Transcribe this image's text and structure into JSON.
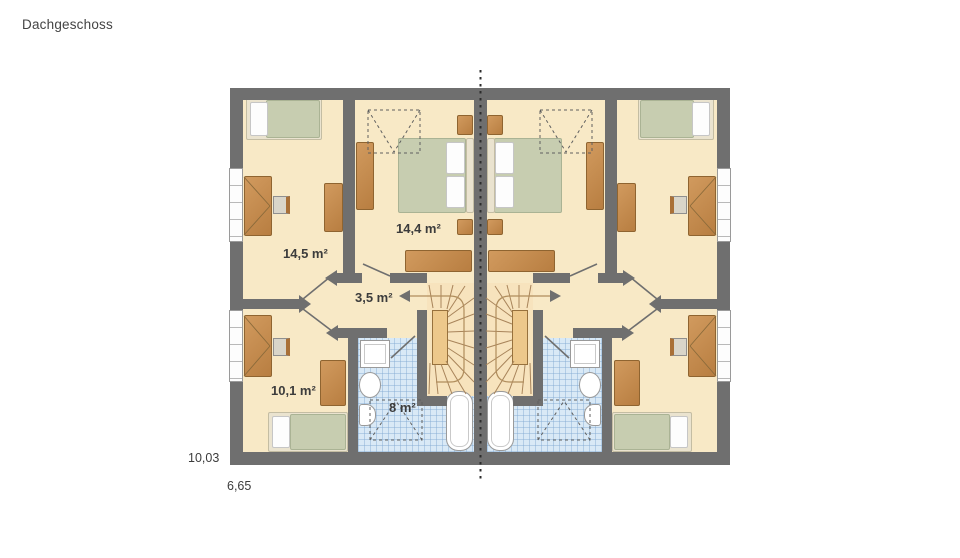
{
  "title": "Dachgeschoss",
  "plan": {
    "floor_name": "Dachgeschoss",
    "rooms": [
      {
        "name": "child-room-top-left",
        "area_label": "14,5 m²"
      },
      {
        "name": "bedroom-left",
        "area_label": "14,4 m²"
      },
      {
        "name": "hallway-left",
        "area_label": "3,5 m²"
      },
      {
        "name": "child-room-bottom-left",
        "area_label": "10,1 m²"
      },
      {
        "name": "bathroom-left",
        "area_label": "8 m²"
      }
    ],
    "dimensions": {
      "overall_width": "10,03",
      "overall_depth": "6,65"
    },
    "colors": {
      "wall": "#6f6f6f",
      "floor": "#f8e9c6",
      "bath_tile": "#d9e9f6",
      "stair": "#f7e3bd",
      "furniture_wood": "#c08a50",
      "bed_green": "#c7cdb0",
      "pillow_white": "#ffffff",
      "background": "#ffffff"
    }
  }
}
